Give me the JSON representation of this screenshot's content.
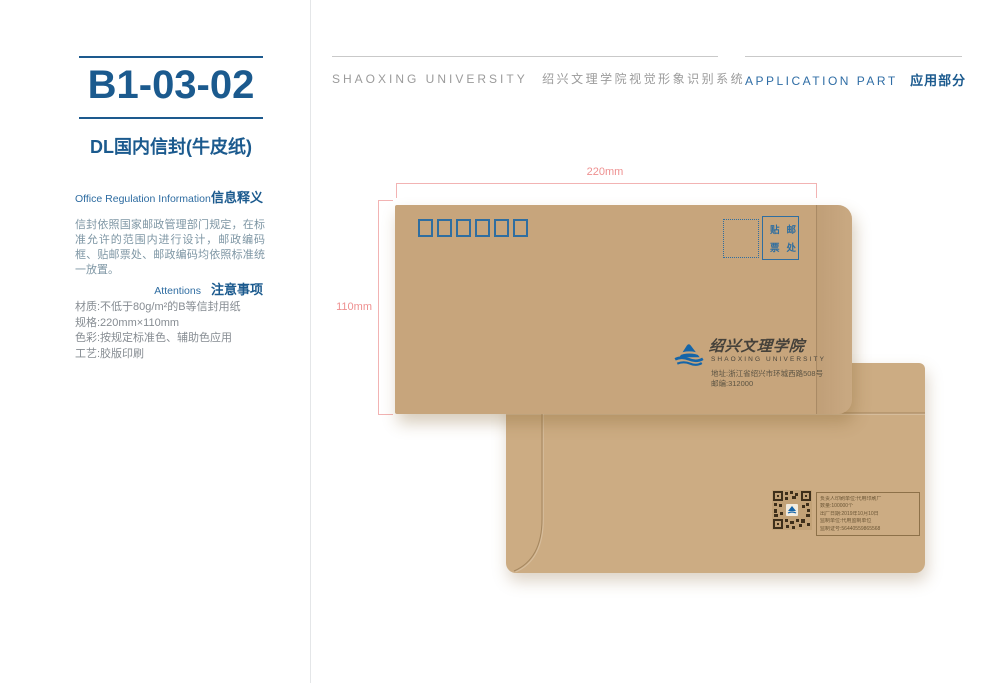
{
  "sidebar": {
    "code": "B1-03-02",
    "title": "DL国内信封(牛皮纸)",
    "section1_en": "Office Regulation Information",
    "section1_zh": "信息释义",
    "body": "信封依照国家邮政管理部门规定，在标准允许的范围内进行设计，邮政编码框、贴邮票处、邮政编码均依照标准统一放置。",
    "section2_en": "Attentions",
    "section2_zh": "注意事项",
    "specs": [
      "材质:不低于80g/m²的B等信封用纸",
      "规格:220mm×110mm",
      "色彩:按规定标准色、辅助色应用",
      "工艺:胶版印刷"
    ]
  },
  "header": {
    "center_en": "SHAOXING UNIVERSITY",
    "center_zh": "绍兴文理学院视觉形象识别系统",
    "right_en": "APPLICATION PART",
    "right_zh": "应用部分"
  },
  "dimensions": {
    "width_label": "220mm",
    "height_label": "110mm"
  },
  "envelope_front": {
    "postal_box_count": 6,
    "stamp_line1": "贴邮",
    "stamp_line2": "票处",
    "logo_zh": "绍兴文理学院",
    "logo_en": "SHAOXING UNIVERSITY",
    "address": "地址:浙江省绍兴市环城西路508号",
    "postcode": "邮编:312000"
  },
  "envelope_back": {
    "print_info": [
      "负责人印刷单位:代用印刷厂",
      "数量:100000个",
      "出厂日期:2019年10月10日",
      "监制单位:代用监制单位",
      "监制证号:56440559865568"
    ]
  },
  "colors": {
    "accent_blue_dark": "#1b5a8e",
    "accent_blue_mid": "#2f6da5",
    "envelope_print_blue": "#2f6ea0",
    "logo_blue": "#1565a8",
    "kraft_front": "#c7a57c",
    "kraft_back": "#ccac83",
    "dimension_pink": "#ee9090",
    "gray_header": "#9b9b9b",
    "qr_brown": "#3e2f1a"
  }
}
